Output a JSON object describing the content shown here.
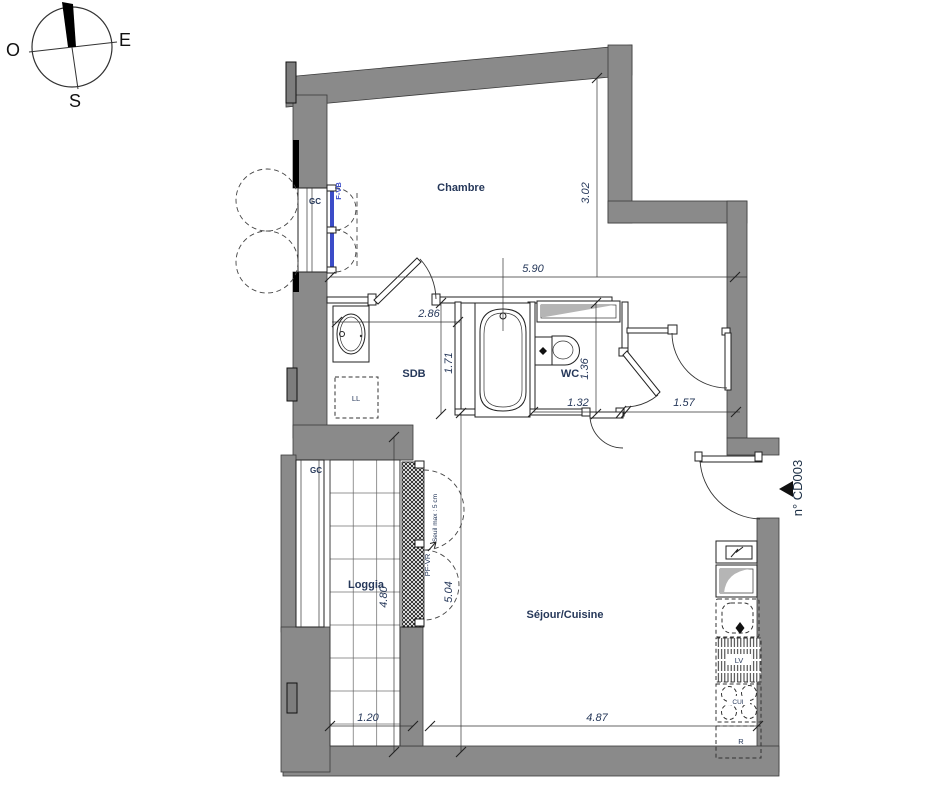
{
  "compass": {
    "west": "O",
    "east": "E",
    "south": "S"
  },
  "rooms": {
    "bedroom": "Chambre",
    "bathroom": "SDB",
    "toilet": "WC",
    "loggia": "Loggia",
    "living": "Séjour/Cuisine"
  },
  "dimensions": {
    "bedroom_width": "5.90",
    "bedroom_height": "3.02",
    "bathroom_width": "2.86",
    "bathroom_height": "1.71",
    "toilet_height": "1.36",
    "toilet_width": "1.32",
    "hall_width": "1.57",
    "loggia_height": "4.80",
    "living_height": "5.04",
    "loggia_width": "1.20",
    "living_width": "4.87"
  },
  "annotations": {
    "guardrail_window": "GC",
    "window_bedroom": "F-VB",
    "guardrail_loggia": "GC",
    "window_living": "PF-VR",
    "threshold_note": "Seuil max : 5 cm",
    "door_number": "n° CD003",
    "washing_machine": "LL",
    "dishwasher": "LV",
    "cooktop": "CUI",
    "fridge": "R"
  },
  "colors": {
    "wall": "#8a8a8a",
    "label_text": "#26385a",
    "window_blue": "#3b4cc8",
    "line": "#222222",
    "shade": "#b5b5b5"
  }
}
